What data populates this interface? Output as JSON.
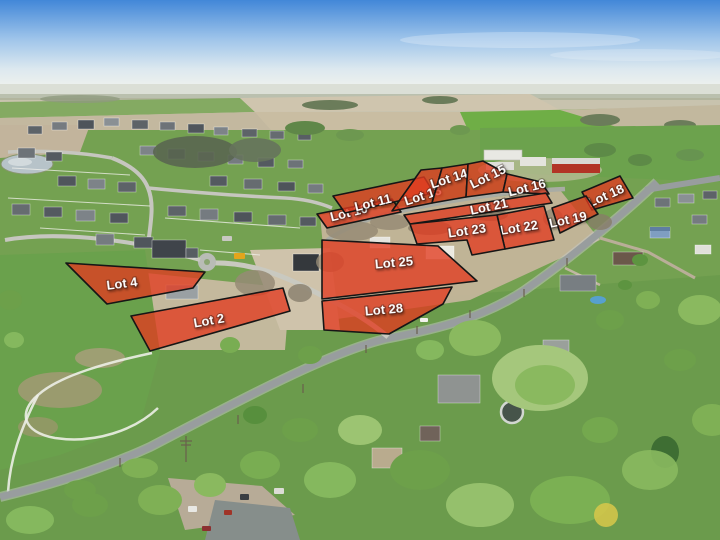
{
  "lots": [
    {
      "label": "Lot 2"
    },
    {
      "label": "Lot 4"
    },
    {
      "label": "Lot 10"
    },
    {
      "label": "Lot 11"
    },
    {
      "label": "Lot 13"
    },
    {
      "label": "Lot 14"
    },
    {
      "label": "Lot 15"
    },
    {
      "label": "Lot 16"
    },
    {
      "label": "Lot 18"
    },
    {
      "label": "Lot 19"
    },
    {
      "label": "Lot 21"
    },
    {
      "label": "Lot 22"
    },
    {
      "label": "Lot 23"
    },
    {
      "label": "Lot 25"
    },
    {
      "label": "Lot 28"
    }
  ],
  "colors": {
    "lot_fill": "#e23b20",
    "lot_stroke": "#161616",
    "lot_label": "#ffffff"
  }
}
